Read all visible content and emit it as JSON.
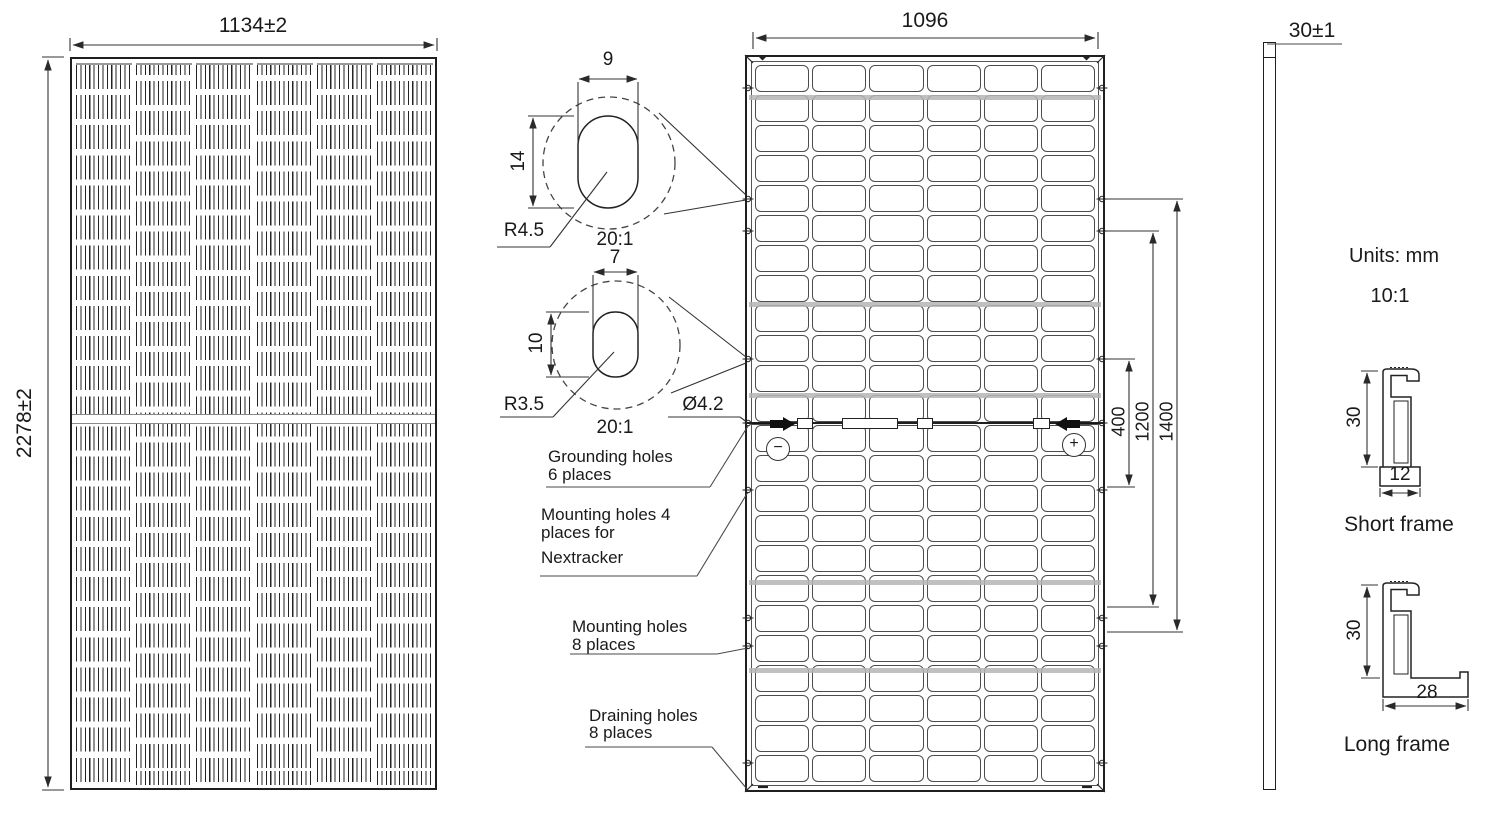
{
  "document": {
    "units_note": "Units: mm",
    "scale_note": "10:1"
  },
  "front_view": {
    "width_dim": "1134±2",
    "height_dim": "2278±2",
    "columns": 6,
    "rows": 24
  },
  "back_view": {
    "width_dim": "1096",
    "columns": 6,
    "rows": 24,
    "hole_spacing_dims": {
      "inner": "400",
      "middle": "1200",
      "outer": "1400"
    },
    "terminal_negative": "−",
    "terminal_positive": "+"
  },
  "side_view": {
    "thickness_dim": "30±1"
  },
  "details": {
    "mounting_slot": {
      "width": "9",
      "height": "14",
      "radius": "R4.5",
      "scale": "20:1"
    },
    "grounding_slot": {
      "width": "7",
      "height": "10",
      "radius": "R3.5",
      "scale": "20:1",
      "hole_diameter": "Ø4.2"
    }
  },
  "callouts": {
    "grounding": {
      "line1": "Grounding holes",
      "line2": "6 places"
    },
    "nextracker": {
      "line1": "Mounting holes 4",
      "line2": "places for",
      "line3": "Nextracker"
    },
    "mounting": {
      "line1": "Mounting holes",
      "line2": "8 places"
    },
    "draining": {
      "line1": "Draining holes",
      "line2": "8 places"
    }
  },
  "frame_sections": {
    "short": {
      "height_dim": "30",
      "width_dim": "12",
      "label": "Short frame"
    },
    "long": {
      "height_dim": "30",
      "width_dim": "28",
      "label": "Long frame"
    }
  }
}
